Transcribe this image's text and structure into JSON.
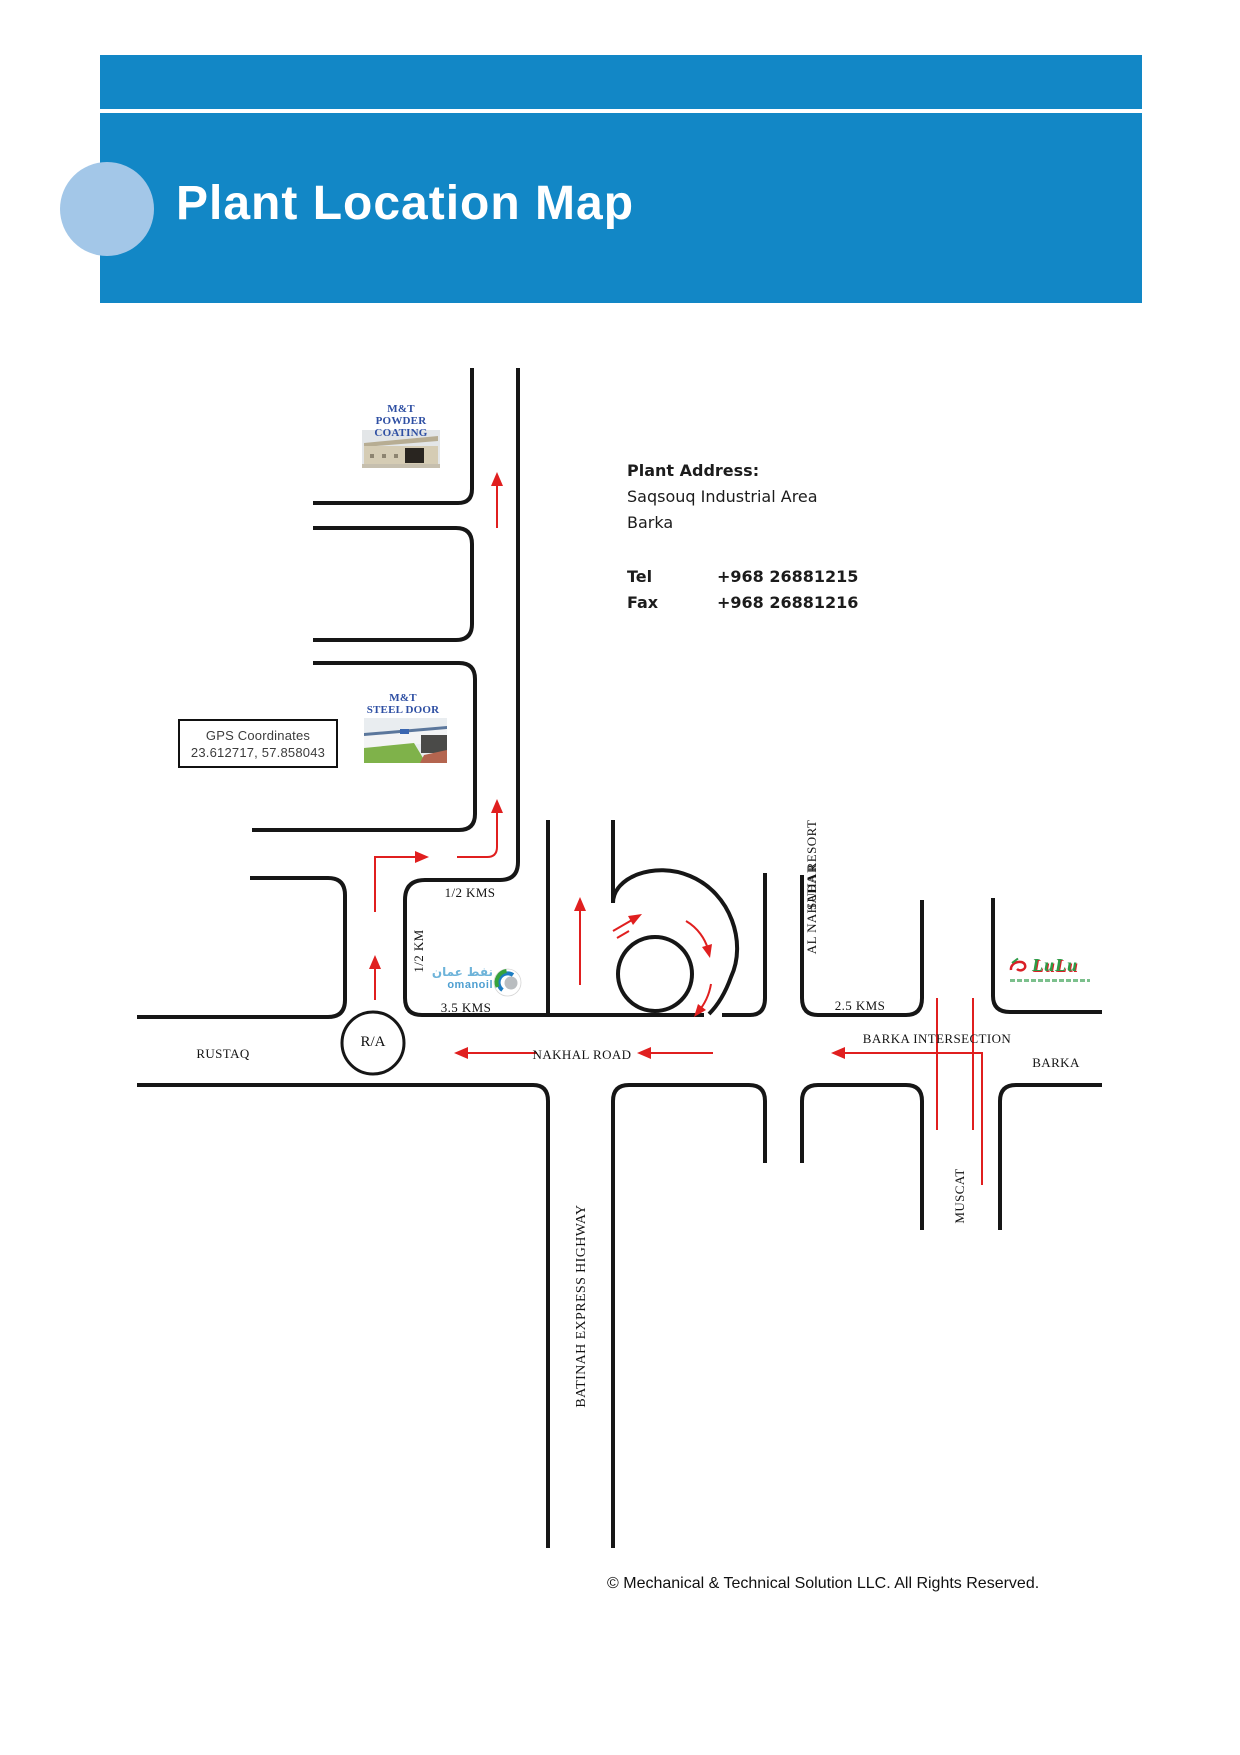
{
  "header": {
    "title": "Plant Location Map"
  },
  "address": {
    "heading": "Plant Address:",
    "line1": "Saqsouq Industrial Area",
    "line2": "Barka",
    "tel_label": "Tel",
    "tel_value": "+968 26881215",
    "fax_label": "Fax",
    "fax_value": "+968 26881216"
  },
  "gps_box": {
    "line1": "GPS Coordinates",
    "line2": "23.612717, 57.858043"
  },
  "sites": {
    "powder_line1": "M&T",
    "powder_line2": "POWDER COATING",
    "steel_line1": "M&T",
    "steel_line2": "STEEL DOOR"
  },
  "labels": {
    "rustaq": "RUSTAQ",
    "roundabout": "R/A",
    "nakhal_road": "NAKHAL ROAD",
    "half_kms": "1/2 KMS",
    "half_km": "1/2 KM",
    "kms_3_5": "3.5 KMS",
    "kms_2_5": "2.5 KMS",
    "barka_intersection": "BARKA INTERSECTION",
    "barka": "BARKA",
    "suhar": "SUHAR",
    "muscat": "MUSCAT",
    "al_nahada_resort": "AL NAHADA RESORT",
    "batinah_highway": "BATINAH EXPRESS HIGHWAY"
  },
  "logos": {
    "omanoil_arabic": "نفط عمان",
    "omanoil_latin": "omanoil",
    "lulu_text": "LuLu"
  },
  "footer": {
    "symbol": "©",
    "text": " Mechanical & Technical Solution LLC. All Rights Reserved."
  },
  "colors": {
    "header_band": "#1287C6",
    "header_circle": "#a3c7e8",
    "road_black": "#161616",
    "route_red": "#e01f1f",
    "site_label_blue": "#2e4fa3",
    "omanoil_blue": "#4e9fd1",
    "lulu_green": "#2e9b47"
  }
}
